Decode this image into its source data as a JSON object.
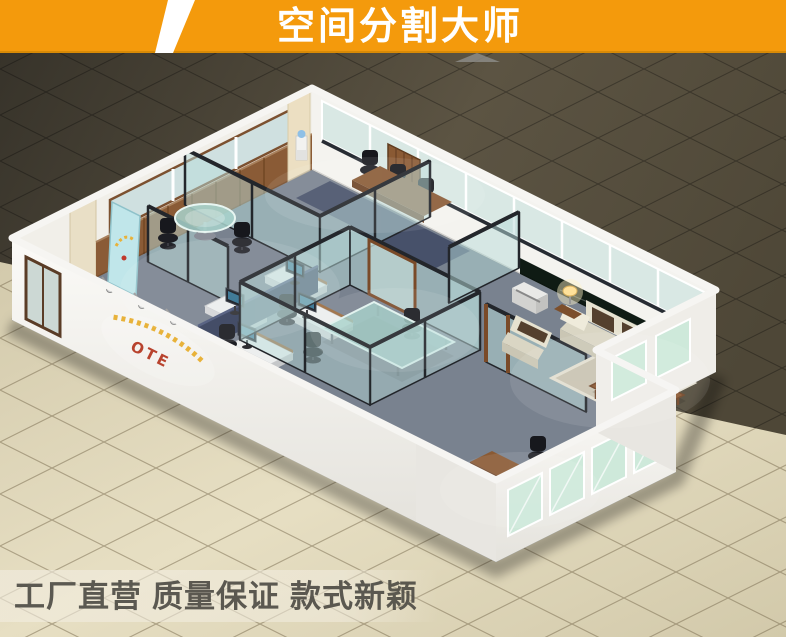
{
  "banner": {
    "title": "空间分割大师"
  },
  "office": {
    "logo": "OTE"
  },
  "footer": {
    "phrases": [
      "工厂直营",
      "质量保证",
      "款式新颖"
    ]
  },
  "colors": {
    "banner_bg": "#F49A0C",
    "banner_text": "#FFFFFF",
    "slash_white": "#FFFFFF",
    "dark_floor": "#4A4438",
    "light_floor": "#DCD3B4",
    "wall_white": "#F6F5F2",
    "glass_pane": "#BCDCDA",
    "partition_frame": "#23262B",
    "carpet_blue_gray": "#79828F",
    "wood_brown": "#8A5A34",
    "sofa_cream": "#E6E2D0",
    "cushion_dark_brown": "#54402E",
    "glass_table_green": "#7CC4B2",
    "logo_red": "#B8432E",
    "logo_gold": "#E8B23A",
    "footer_text": "#4F4D46"
  }
}
